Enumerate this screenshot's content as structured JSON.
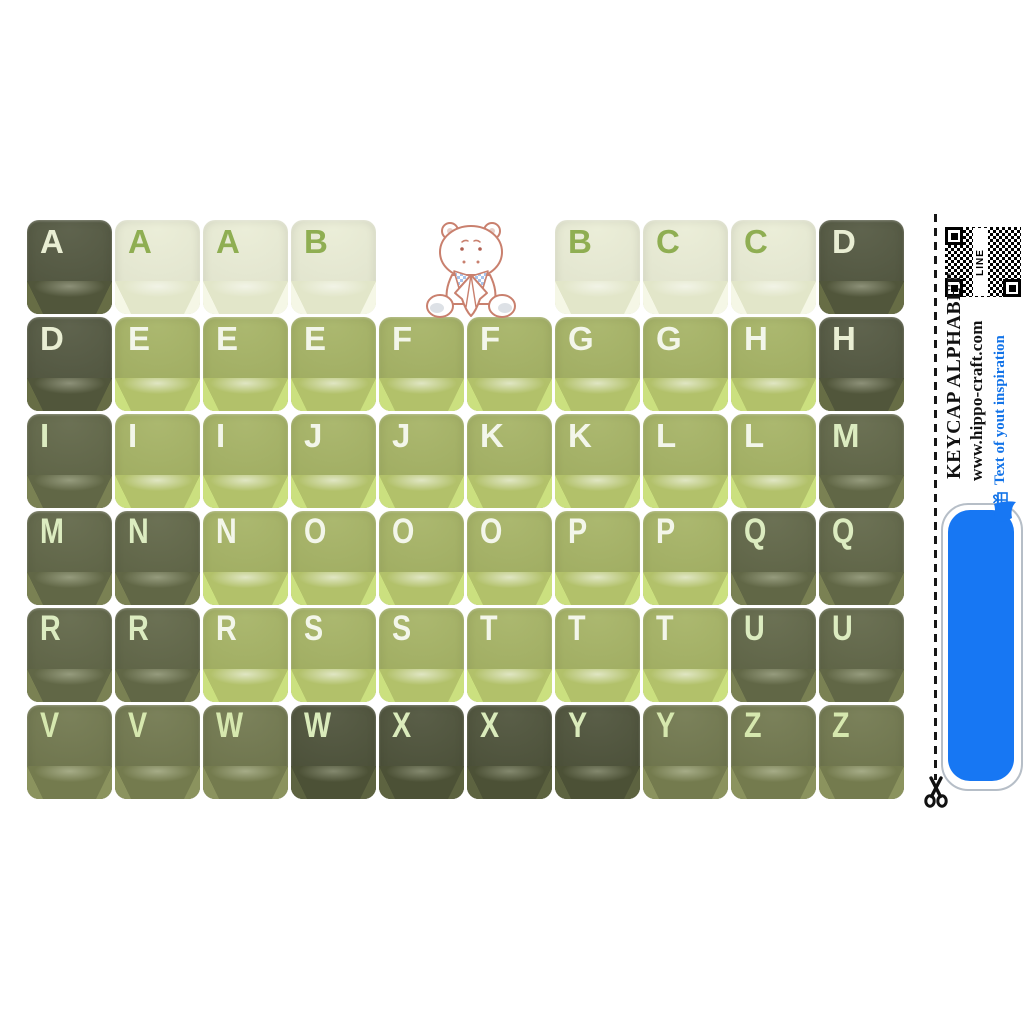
{
  "page": {
    "background": "#ffffff"
  },
  "keyboard": {
    "cols": 10,
    "col_pitch": 88,
    "row_pitch": 97,
    "palette": {
      "cream": {
        "top": "#e9ecd4",
        "front": "#e2e6c9",
        "bevel": "#f5f7e6",
        "letter": "#8fae52",
        "hl": "rgba(255,255,255,0.55)"
      },
      "green": {
        "top": "#a2b05f",
        "front": "#b2c16a",
        "bevel": "#cbe07f",
        "letter": "#f3f6ea",
        "hl": "rgba(255,255,255,0.60)"
      },
      "dark": {
        "top": "#4d523a",
        "front": "#51563b",
        "bevel": "#676d45",
        "letter": "#e9eed3",
        "hl": "rgba(230,232,212,0.40)"
      },
      "olive": {
        "top": "#5b6141",
        "front": "#616746",
        "bevel": "#7a8153",
        "letter": "#dcecc0",
        "hl": "rgba(235,240,215,0.38)"
      },
      "molive": {
        "top": "#6c7348",
        "front": "#747b4e",
        "bevel": "#8b935e",
        "letter": "#d6e8ae",
        "hl": "rgba(235,240,215,0.42)"
      },
      "dark2": {
        "top": "#474c33",
        "front": "#4c5136",
        "bevel": "#5d6340",
        "letter": "#daebbb",
        "hl": "rgba(230,235,210,0.36)"
      }
    },
    "rows": [
      {
        "keys": [
          {
            "letter": "A",
            "tone": "dark",
            "col": 0
          },
          {
            "letter": "A",
            "tone": "cream",
            "col": 1
          },
          {
            "letter": "A",
            "tone": "cream",
            "col": 2
          },
          {
            "letter": "B",
            "tone": "cream",
            "col": 3
          },
          {
            "letter": "B",
            "tone": "cream",
            "col": 6
          },
          {
            "letter": "C",
            "tone": "cream",
            "col": 7
          },
          {
            "letter": "C",
            "tone": "cream",
            "col": 8
          },
          {
            "letter": "D",
            "tone": "dark",
            "col": 9
          }
        ]
      },
      {
        "keys": [
          {
            "letter": "D",
            "tone": "dark",
            "col": 0
          },
          {
            "letter": "E",
            "tone": "green",
            "col": 1
          },
          {
            "letter": "E",
            "tone": "green",
            "col": 2
          },
          {
            "letter": "E",
            "tone": "green",
            "col": 3
          },
          {
            "letter": "F",
            "tone": "green",
            "col": 4
          },
          {
            "letter": "F",
            "tone": "green",
            "col": 5
          },
          {
            "letter": "G",
            "tone": "green",
            "col": 6
          },
          {
            "letter": "G",
            "tone": "green",
            "col": 7
          },
          {
            "letter": "H",
            "tone": "green",
            "col": 8
          },
          {
            "letter": "H",
            "tone": "dark",
            "col": 9
          }
        ]
      },
      {
        "keys": [
          {
            "letter": "I",
            "tone": "olive",
            "col": 0
          },
          {
            "letter": "I",
            "tone": "green",
            "col": 1
          },
          {
            "letter": "I",
            "tone": "green",
            "col": 2
          },
          {
            "letter": "J",
            "tone": "green",
            "col": 3
          },
          {
            "letter": "J",
            "tone": "green",
            "col": 4
          },
          {
            "letter": "K",
            "tone": "green",
            "col": 5
          },
          {
            "letter": "K",
            "tone": "green",
            "col": 6
          },
          {
            "letter": "L",
            "tone": "green",
            "col": 7
          },
          {
            "letter": "L",
            "tone": "green",
            "col": 8
          },
          {
            "letter": "M",
            "tone": "olive",
            "col": 9
          }
        ]
      },
      {
        "keys": [
          {
            "letter": "M",
            "tone": "olive",
            "col": 0
          },
          {
            "letter": "N",
            "tone": "olive",
            "col": 1
          },
          {
            "letter": "N",
            "tone": "green",
            "col": 2
          },
          {
            "letter": "O",
            "tone": "green",
            "col": 3
          },
          {
            "letter": "O",
            "tone": "green",
            "col": 4
          },
          {
            "letter": "O",
            "tone": "green",
            "col": 5
          },
          {
            "letter": "P",
            "tone": "green",
            "col": 6
          },
          {
            "letter": "P",
            "tone": "green",
            "col": 7
          },
          {
            "letter": "Q",
            "tone": "olive",
            "col": 8
          },
          {
            "letter": "Q",
            "tone": "olive",
            "col": 9
          }
        ]
      },
      {
        "keys": [
          {
            "letter": "R",
            "tone": "olive",
            "col": 0
          },
          {
            "letter": "R",
            "tone": "olive",
            "col": 1
          },
          {
            "letter": "R",
            "tone": "green",
            "col": 2
          },
          {
            "letter": "S",
            "tone": "green",
            "col": 3
          },
          {
            "letter": "S",
            "tone": "green",
            "col": 4
          },
          {
            "letter": "T",
            "tone": "green",
            "col": 5
          },
          {
            "letter": "T",
            "tone": "green",
            "col": 6
          },
          {
            "letter": "T",
            "tone": "green",
            "col": 7
          },
          {
            "letter": "U",
            "tone": "olive",
            "col": 8
          },
          {
            "letter": "U",
            "tone": "olive",
            "col": 9
          }
        ]
      },
      {
        "keys": [
          {
            "letter": "V",
            "tone": "molive",
            "col": 0
          },
          {
            "letter": "V",
            "tone": "molive",
            "col": 1
          },
          {
            "letter": "W",
            "tone": "molive",
            "col": 2
          },
          {
            "letter": "W",
            "tone": "dark2",
            "col": 3
          },
          {
            "letter": "X",
            "tone": "dark2",
            "col": 4
          },
          {
            "letter": "X",
            "tone": "dark2",
            "col": 5
          },
          {
            "letter": "Y",
            "tone": "dark2",
            "col": 6
          },
          {
            "letter": "Y",
            "tone": "molive",
            "col": 7
          },
          {
            "letter": "Z",
            "tone": "molive",
            "col": 8
          },
          {
            "letter": "Z",
            "tone": "molive",
            "col": 9
          }
        ]
      }
    ]
  },
  "sidebar": {
    "title": "KEYCAP ALPHABET",
    "website": "www.hippo-craft.com",
    "inspiration_label": "Text of yout inspiration",
    "qr_label": "LINE",
    "colors": {
      "accent_blue": "#1777f3",
      "text_blue": "#1273e8",
      "bubble_outline": "#b6bec7"
    }
  },
  "mascot": {
    "name": "hippo",
    "outline_color": "#c9806e",
    "bib_color": "#a6c4ec"
  }
}
